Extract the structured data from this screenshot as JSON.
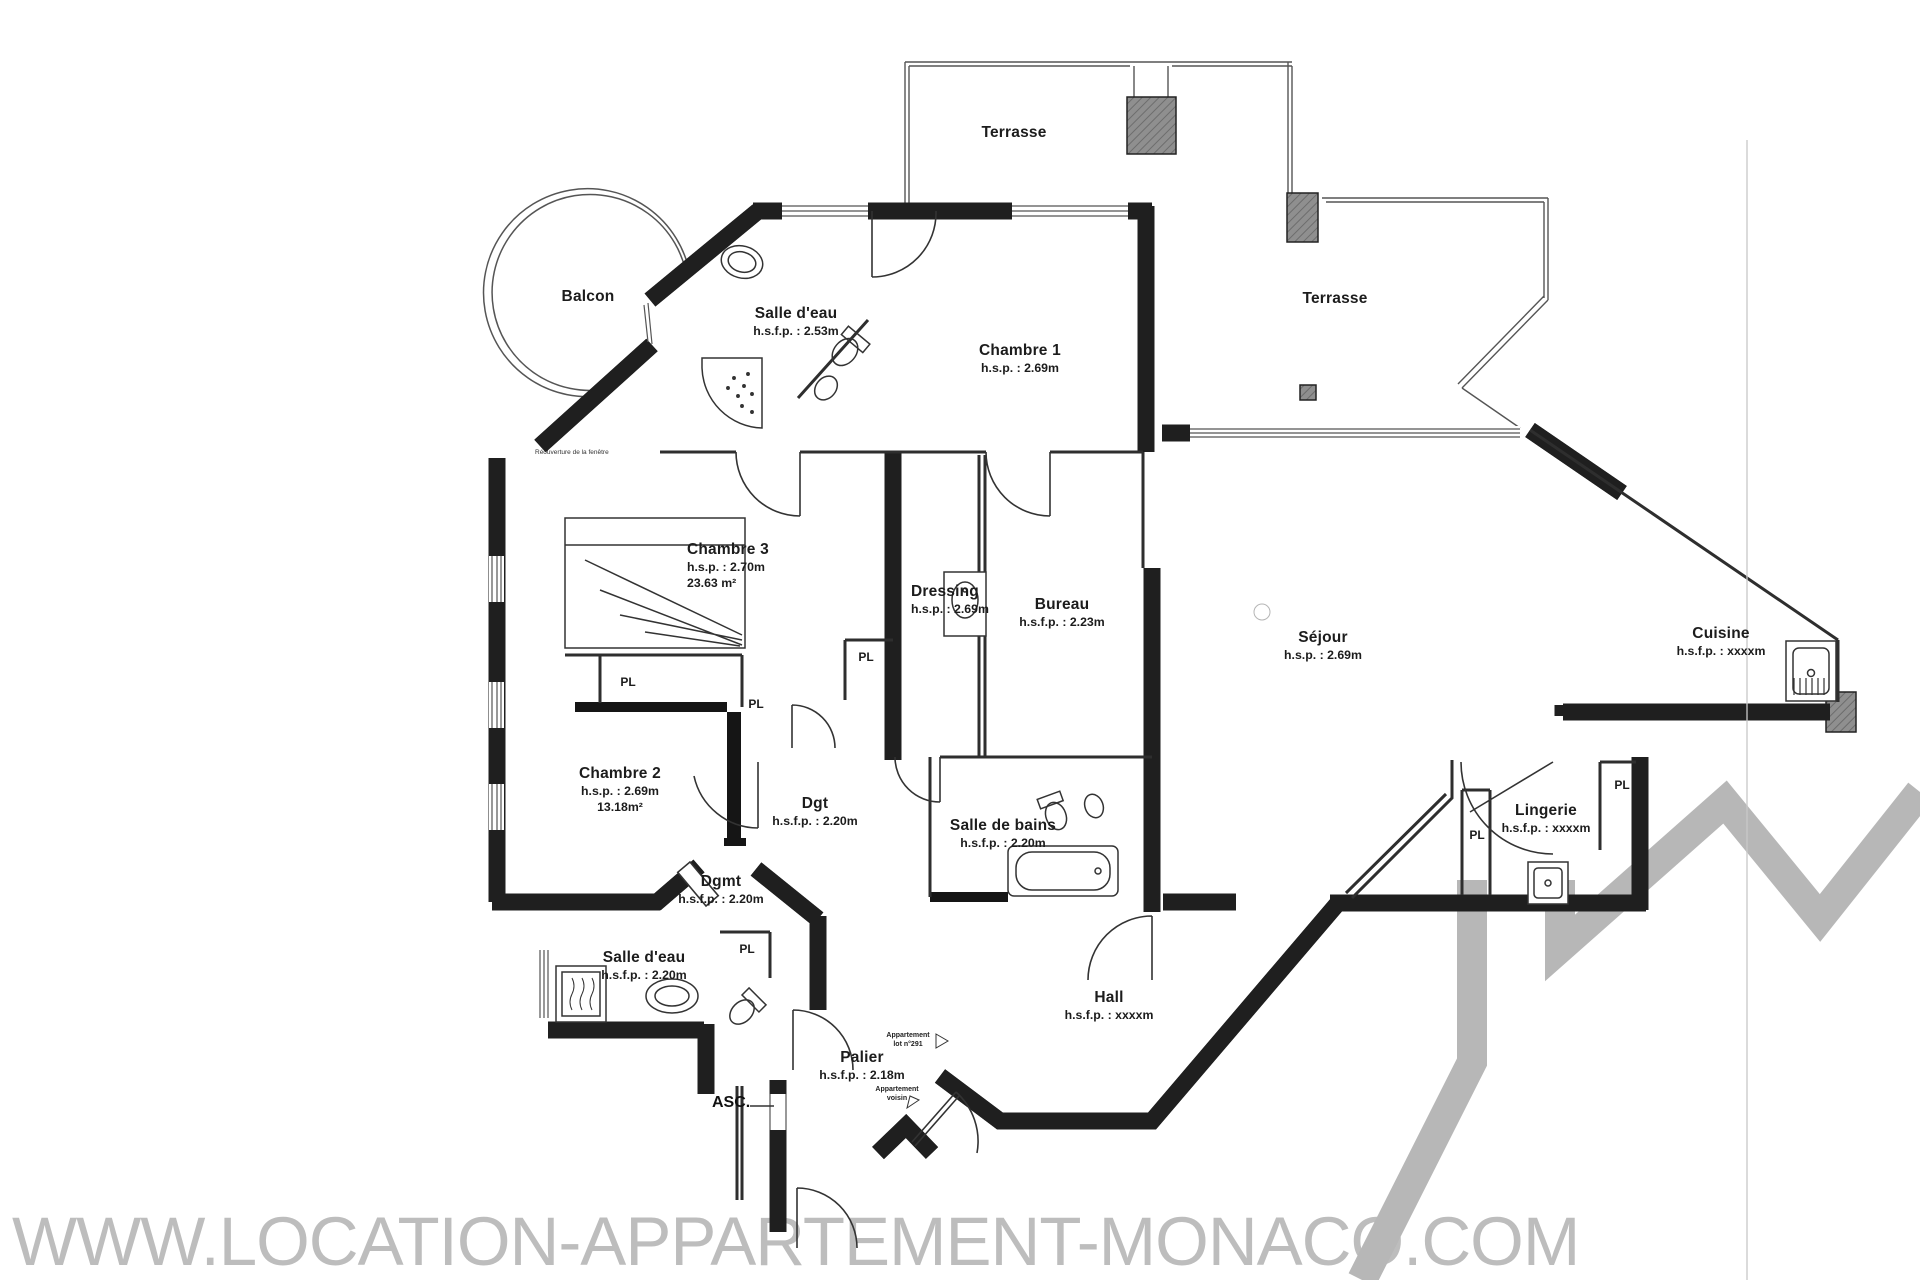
{
  "page": {
    "watermark": "WWW.LOCATION-APPARTEMENT-MONACO.COM"
  },
  "colors": {
    "paper": "#ffffff",
    "wall_fill_gray": "#949494",
    "wall_edge_black": "#1f1f1f",
    "thin_line": "#2e2e2e",
    "logo_gray": "#b7b7b7",
    "watermark_gray": "#bdbdbd"
  },
  "labels": {
    "pl": "PL",
    "asc": "ASC."
  },
  "rooms": {
    "terrasse_top": {
      "name": "Terrasse"
    },
    "terrasse_right": {
      "name": "Terrasse"
    },
    "balcon": {
      "name": "Balcon"
    },
    "salle_eau_haut": {
      "name": "Salle d'eau",
      "height": "h.s.f.p. : 2.53m"
    },
    "chambre1": {
      "name": "Chambre 1",
      "height": "h.s.p. : 2.69m"
    },
    "chambre3": {
      "name": "Chambre 3",
      "height": "h.s.p. : 2.70m",
      "area": "23.63 m²"
    },
    "dressing": {
      "name": "Dressing",
      "height": "h.s.p. : 2.69m"
    },
    "bureau": {
      "name": "Bureau",
      "height": "h.s.f.p. : 2.23m"
    },
    "sejour": {
      "name": "Séjour",
      "height": "h.s.p. : 2.69m"
    },
    "cuisine": {
      "name": "Cuisine",
      "height": "h.s.f.p. : xxxxm"
    },
    "chambre2": {
      "name": "Chambre 2",
      "height": "h.s.p. : 2.69m",
      "area": "13.18m²"
    },
    "dgt": {
      "name": "Dgt",
      "height": "h.s.f.p. : 2.20m"
    },
    "dgmt": {
      "name": "Dgmt",
      "height": "h.s.f.p. : 2.20m"
    },
    "salle_de_bains": {
      "name": "Salle de bains",
      "height": "h.s.f.p. : 2.20m"
    },
    "lingerie": {
      "name": "Lingerie",
      "height": "h.s.f.p. : xxxxm"
    },
    "salle_eau_bas": {
      "name": "Salle d'eau",
      "height": "h.s.f.p. : 2.20m"
    },
    "hall": {
      "name": "Hall",
      "height": "h.s.f.p. : xxxxm"
    },
    "palier": {
      "name": "Palier",
      "height": "h.s.f.p. : 2.18m"
    }
  },
  "annotations": {
    "reouverture": "Réouverture de la fenêtre",
    "appartement_lot_l1": "Appartement",
    "appartement_lot_l2": "lot n°291",
    "appartement_voisin_l1": "Appartement",
    "appartement_voisin_l2": "voisin"
  }
}
